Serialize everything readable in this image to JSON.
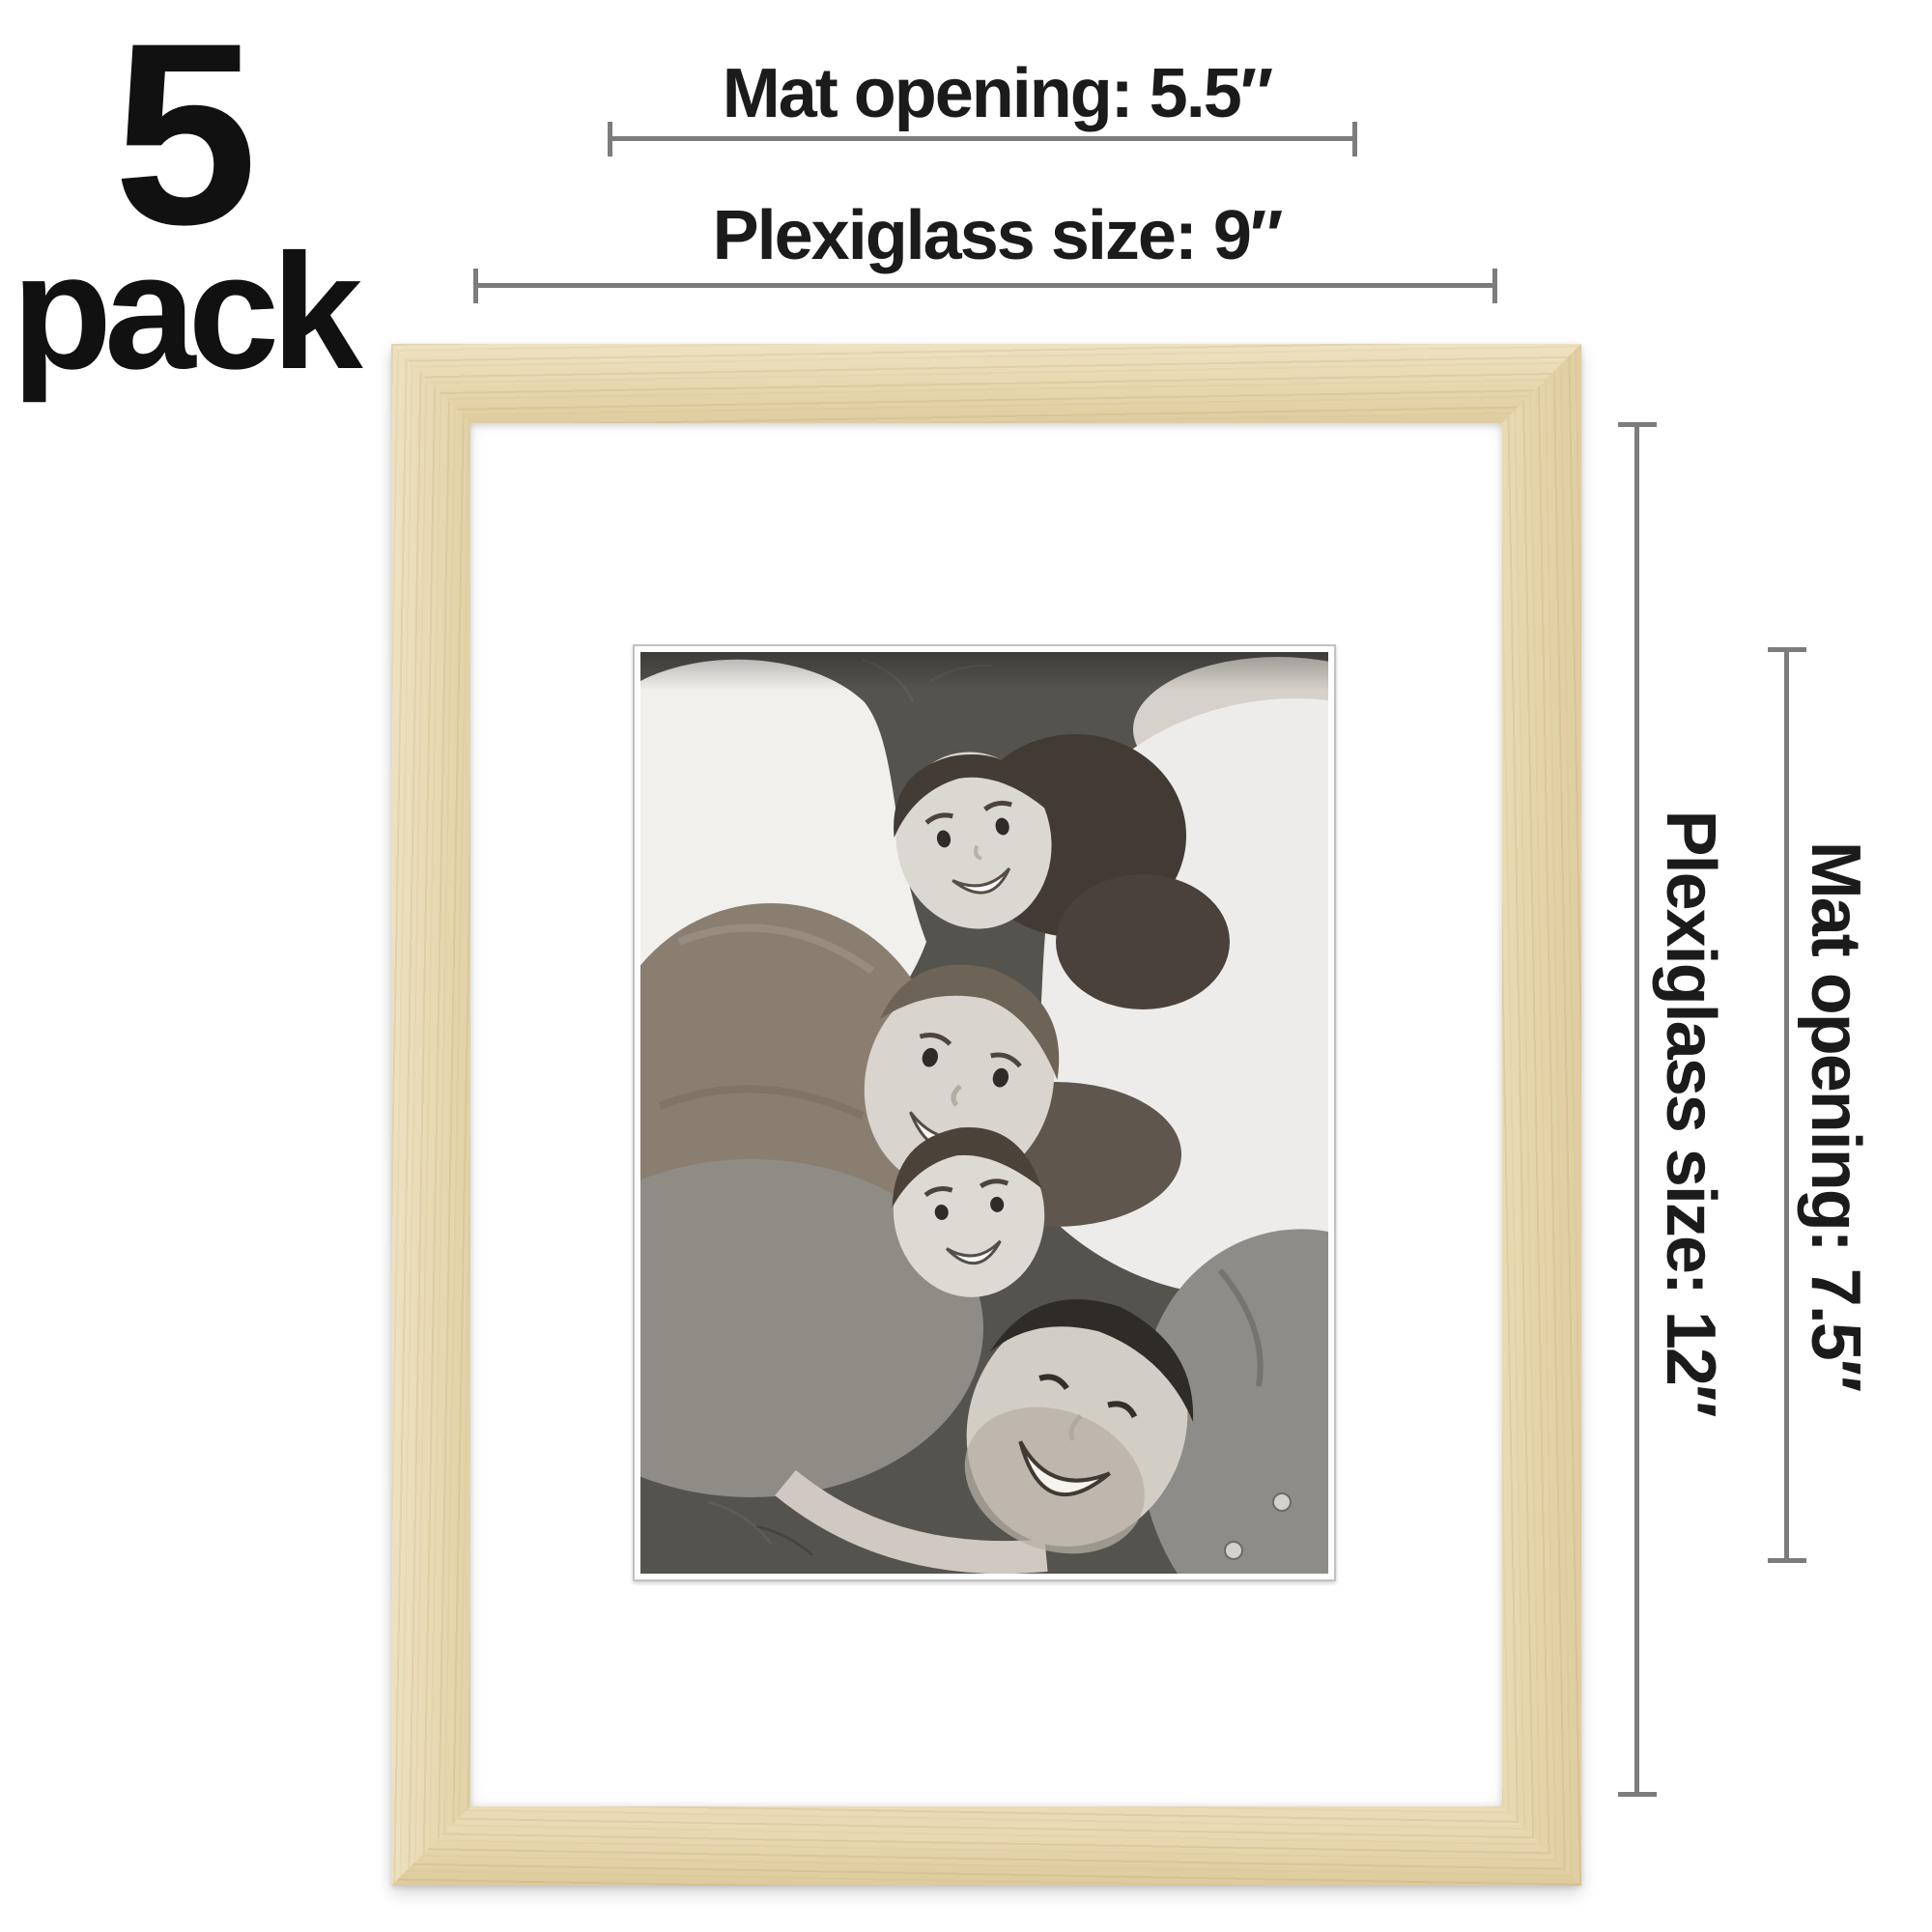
{
  "badge": {
    "number": "5",
    "word": "pack"
  },
  "annotations": {
    "top": [
      {
        "label": "Mat opening: 5.5″"
      },
      {
        "label": "Plexiglass size: 9″"
      }
    ],
    "right": [
      {
        "label": "Plexiglass size: 12″"
      },
      {
        "label": "Mat opening: 7.5″"
      }
    ]
  },
  "frame": {
    "photo_alt": "Black and white photo of a family of four lying on grass with their heads together"
  },
  "colors": {
    "text": "#1b1b1b",
    "line": "#7c7c7c",
    "wood": "#e6d6ae",
    "wood_dark": "#dcc89c",
    "wood_light": "#efe3c2",
    "mat": "#ffffff",
    "background": "#ffffff"
  }
}
